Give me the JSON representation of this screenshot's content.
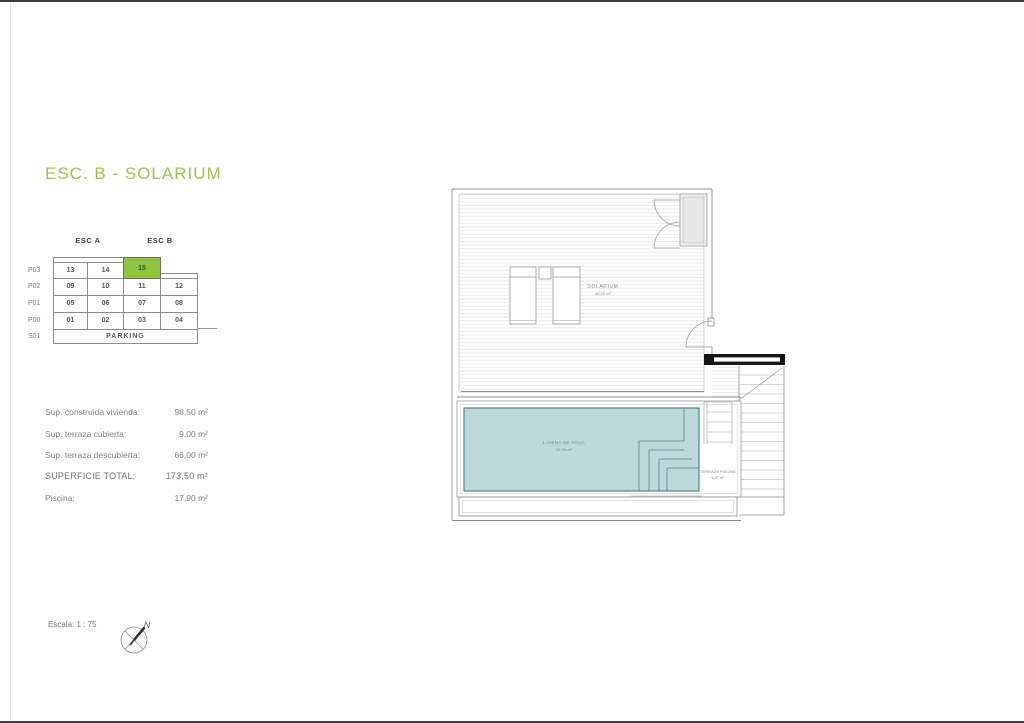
{
  "page": {
    "title": "ESC. B - SOLARIUM",
    "scale_label": "Escala: 1 : 75",
    "compass_north": "N",
    "colors": {
      "title_green": "#9dc44f",
      "highlight_green": "#8dc63f",
      "pool_fill": "#bcdada",
      "pool_stroke": "#55828c"
    }
  },
  "unit_table": {
    "col_groups": [
      {
        "label": "ESC A"
      },
      {
        "label": "ESC B"
      }
    ],
    "rows": [
      {
        "label": "P03",
        "cells": [
          "13",
          "14",
          "15",
          ""
        ],
        "highlighted_cell": "15"
      },
      {
        "label": "P02",
        "cells": [
          "09",
          "10",
          "11",
          "12"
        ]
      },
      {
        "label": "P01",
        "cells": [
          "05",
          "06",
          "07",
          "08"
        ]
      },
      {
        "label": "P00",
        "cells": [
          "01",
          "02",
          "03",
          "04"
        ]
      },
      {
        "label": "S01",
        "span_text": "PARKING"
      }
    ]
  },
  "areas": {
    "rows": [
      {
        "label": "Sup. construida vivienda:",
        "value": "98,50 m²"
      },
      {
        "label": "Sup. terraza cubierta:",
        "value": "9,00 m²"
      },
      {
        "label": "Sup. terraza descubierta:",
        "value": "66,00 m²"
      },
      {
        "label": "SUPERFICIE TOTAL:",
        "value": "173,50 m²"
      },
      {
        "label": "Piscina:",
        "value": "17,90 m²"
      }
    ]
  },
  "plan": {
    "solarium_label": "SOLARIUM",
    "solarium_area": "46,03 m²",
    "pool_label": "LAMINA DE AGUA",
    "pool_area": "17,90 m²",
    "terrace_label": "TERRAZA PISCINA",
    "terrace_area": "6,47 m²"
  }
}
